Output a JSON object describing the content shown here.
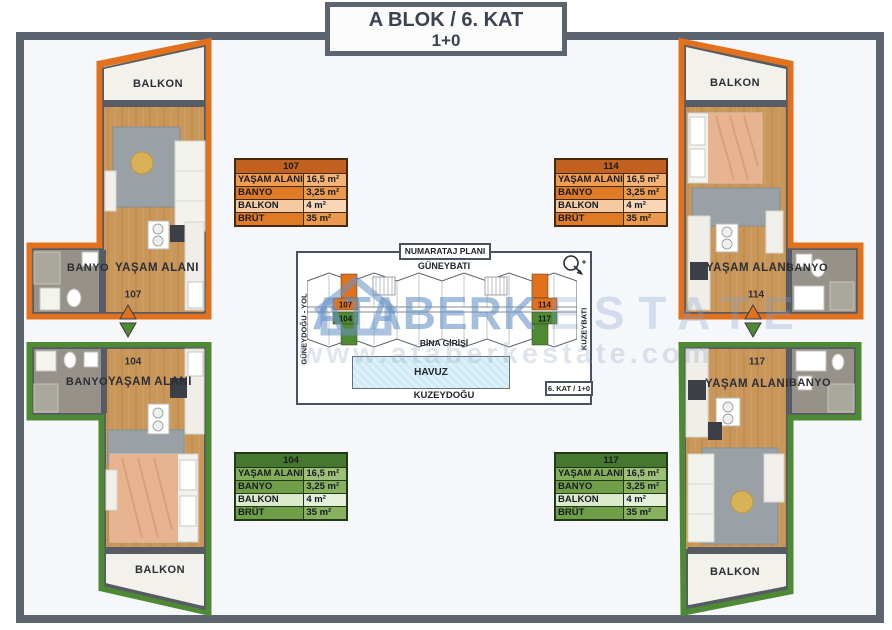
{
  "header": {
    "title": "A BLOK / 6. KAT",
    "subtitle": "1+0"
  },
  "units": {
    "u107": {
      "number": "107",
      "living": "YAŞAM ALANI",
      "bath": "BANYO",
      "balcony": "BALKON"
    },
    "u114": {
      "number": "114",
      "living": "YAŞAM ALANI",
      "bath": "BANYO",
      "balcony": "BALKON"
    },
    "u104": {
      "number": "104",
      "living": "YAŞAM ALANI",
      "bath": "BANYO",
      "balcony": "BALKON"
    },
    "u117": {
      "number": "117",
      "living": "YAŞAM ALANI",
      "bath": "BANYO",
      "balcony": "BALKON"
    }
  },
  "tables": {
    "t107": {
      "number": "107",
      "rows": [
        {
          "label": "YAŞAM ALANI",
          "value": "16,5 m²"
        },
        {
          "label": "BANYO",
          "value": "3,25 m²"
        },
        {
          "label": "BALKON",
          "value": "4 m²"
        },
        {
          "label": "BRÜT",
          "value": "35 m²"
        }
      ]
    },
    "t114": {
      "number": "114",
      "rows": [
        {
          "label": "YAŞAM ALANI",
          "value": "16,5 m²"
        },
        {
          "label": "BANYO",
          "value": "3,25 m²"
        },
        {
          "label": "BALKON",
          "value": "4 m²"
        },
        {
          "label": "BRÜT",
          "value": "35 m²"
        }
      ]
    },
    "t104": {
      "number": "104",
      "rows": [
        {
          "label": "YAŞAM ALANI",
          "value": "16,5 m²"
        },
        {
          "label": "BANYO",
          "value": "3,25 m²"
        },
        {
          "label": "BALKON",
          "value": "4 m²"
        },
        {
          "label": "BRÜT",
          "value": "35 m²"
        }
      ]
    },
    "t117": {
      "number": "117",
      "rows": [
        {
          "label": "YAŞAM ALANI",
          "value": "16,5 m²"
        },
        {
          "label": "BANYO",
          "value": "3,25 m²"
        },
        {
          "label": "BALKON",
          "value": "4 m²"
        },
        {
          "label": "BRÜT",
          "value": "35 m²"
        }
      ]
    }
  },
  "plan": {
    "title": "NUMARATAJ PLANI",
    "direction_top": "GÜNEYBATI",
    "direction_bottom": "KUZEYDOĞU",
    "direction_left": "GÜNEYDOĞU - YOL",
    "direction_right": "KUZEYBATI",
    "entrance_label": "BİNA GİRİŞİ",
    "pool_label": "HAVUZ",
    "floor_badge": "6. KAT / 1+0",
    "unit_tl": "107",
    "unit_bl": "104",
    "unit_tr": "114",
    "unit_br": "117"
  },
  "watermark": {
    "brand": "ATABERK",
    "brand_suffix": "ESTATE",
    "url": "www.ataberkestate.com"
  },
  "colors": {
    "orange": "#e2711d",
    "green": "#4e8a33",
    "frame": "#5c6470",
    "pool_fill": "#cdeaf6"
  }
}
